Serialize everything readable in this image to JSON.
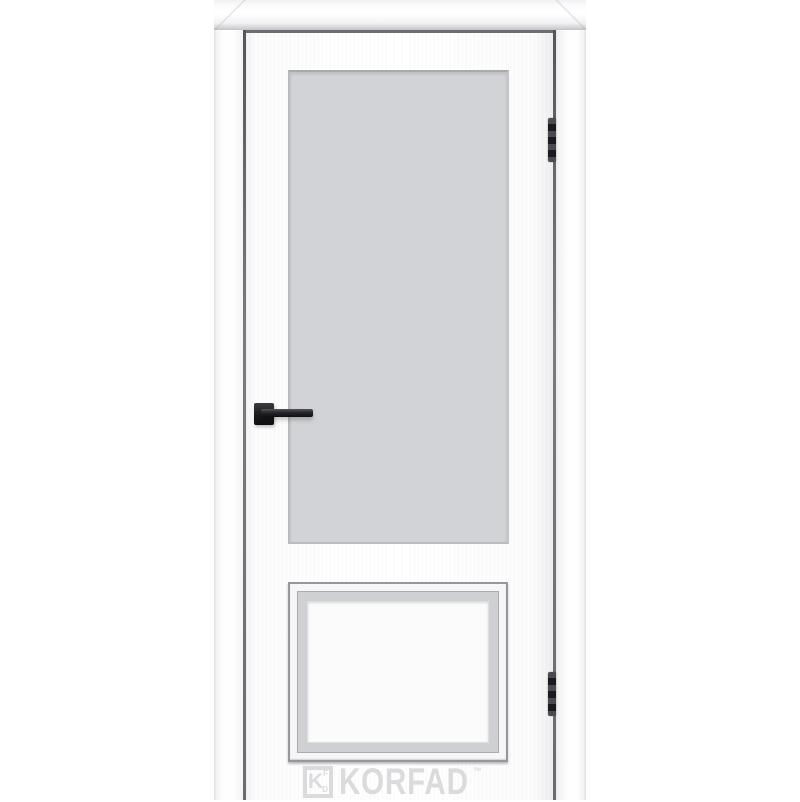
{
  "image": {
    "type": "product-photo",
    "subject": "white interior door in frame with large frosted glass upper light, raised lower panel, black lever handle and two dark hinges"
  },
  "colors": {
    "background": "#ffffff",
    "glass": "#d2d3d6",
    "panel_band": "#cfd0d3",
    "gap_line": "#6e6e72",
    "handle": "#1d1d1f",
    "hinge": "#2e2e32",
    "watermark": "#dbdbdd"
  },
  "hardware": {
    "hinge_count": 2
  },
  "watermark": {
    "logo_letter": "K",
    "logo_small_top": "F",
    "logo_small_bottom": "D",
    "brand": "KORFAD",
    "trademark": "™"
  }
}
